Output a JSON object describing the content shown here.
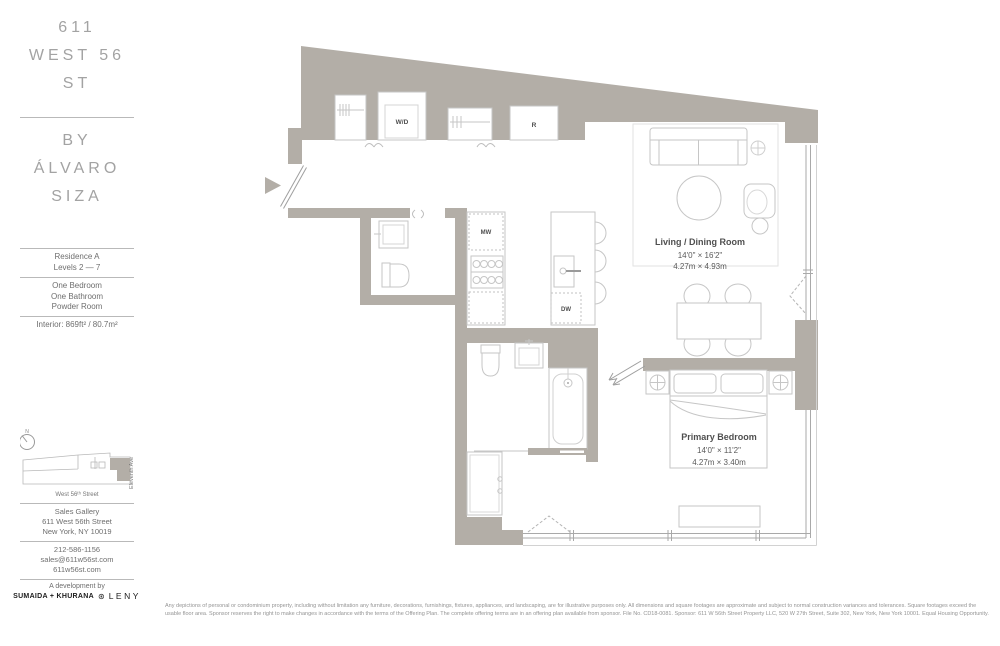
{
  "sidebar": {
    "building_title": {
      "line1": "611",
      "line2": "WEST 56",
      "line3": "ST"
    },
    "architect": {
      "line1": "BY",
      "line2": "ÁLVARO",
      "line3": "SIZA"
    },
    "residence_name": "Residence A",
    "residence_levels": "Levels 2 — 7",
    "room1": "One Bedroom",
    "room2": "One Bathroom",
    "room3": "Powder Room",
    "interior_area": "Interior: 869ft² / 80.7m²",
    "map": {
      "north": "N",
      "avenue": "Eleventh Ave",
      "street": "West 56ᵗʰ Street"
    },
    "gallery": {
      "line1": "Sales Gallery",
      "line2": "611 West 56th Street",
      "line3": "New York, NY 10019"
    },
    "contact": {
      "phone": "212-586-1156",
      "email": "sales@611w56st.com",
      "website": "611w56st.com"
    },
    "development": {
      "prefix": "A development by",
      "developer1": "SUMAIDA + KHURANA",
      "logo": "⊛",
      "developer2": "LENY"
    }
  },
  "floorplan": {
    "living": {
      "name": "Living / Dining Room",
      "imperial": "14'0\" × 16'2\"",
      "metric": "4.27m × 4.93m"
    },
    "bedroom": {
      "name": "Primary Bedroom",
      "imperial": "14'0\" × 11'2\"",
      "metric": "4.27m × 3.40m"
    },
    "labels": {
      "washer_dryer": "W/D",
      "refrigerator": "R",
      "microwave": "MW",
      "dishwasher": "DW"
    }
  },
  "disclaimer": "Any depictions of personal or condominium property, including without limitation any furniture, decorations, furnishings, fixtures, appliances, and landscaping, are for illustrative purposes only. All dimensions and square footages are approximate and subject to normal construction variances and tolerances. Square footages exceed the usable floor area. Sponsor reserves the right to make changes in accordance with the terms of the Offering Plan. The complete offering terms are in an offering plan available from sponsor. File No. CD18-0081. Sponsor: 611 W 56th Street Property LLC, 520 W 27th Street, Suite 302, New York, New York 10001. Equal Housing Opportunity.",
  "colors": {
    "wall": "#b3aea7",
    "furniture_line": "#c6c6c6",
    "window_line": "#a9a9a9",
    "plan_text": "#4f4f4f",
    "title_text": "#a3a3a3"
  }
}
